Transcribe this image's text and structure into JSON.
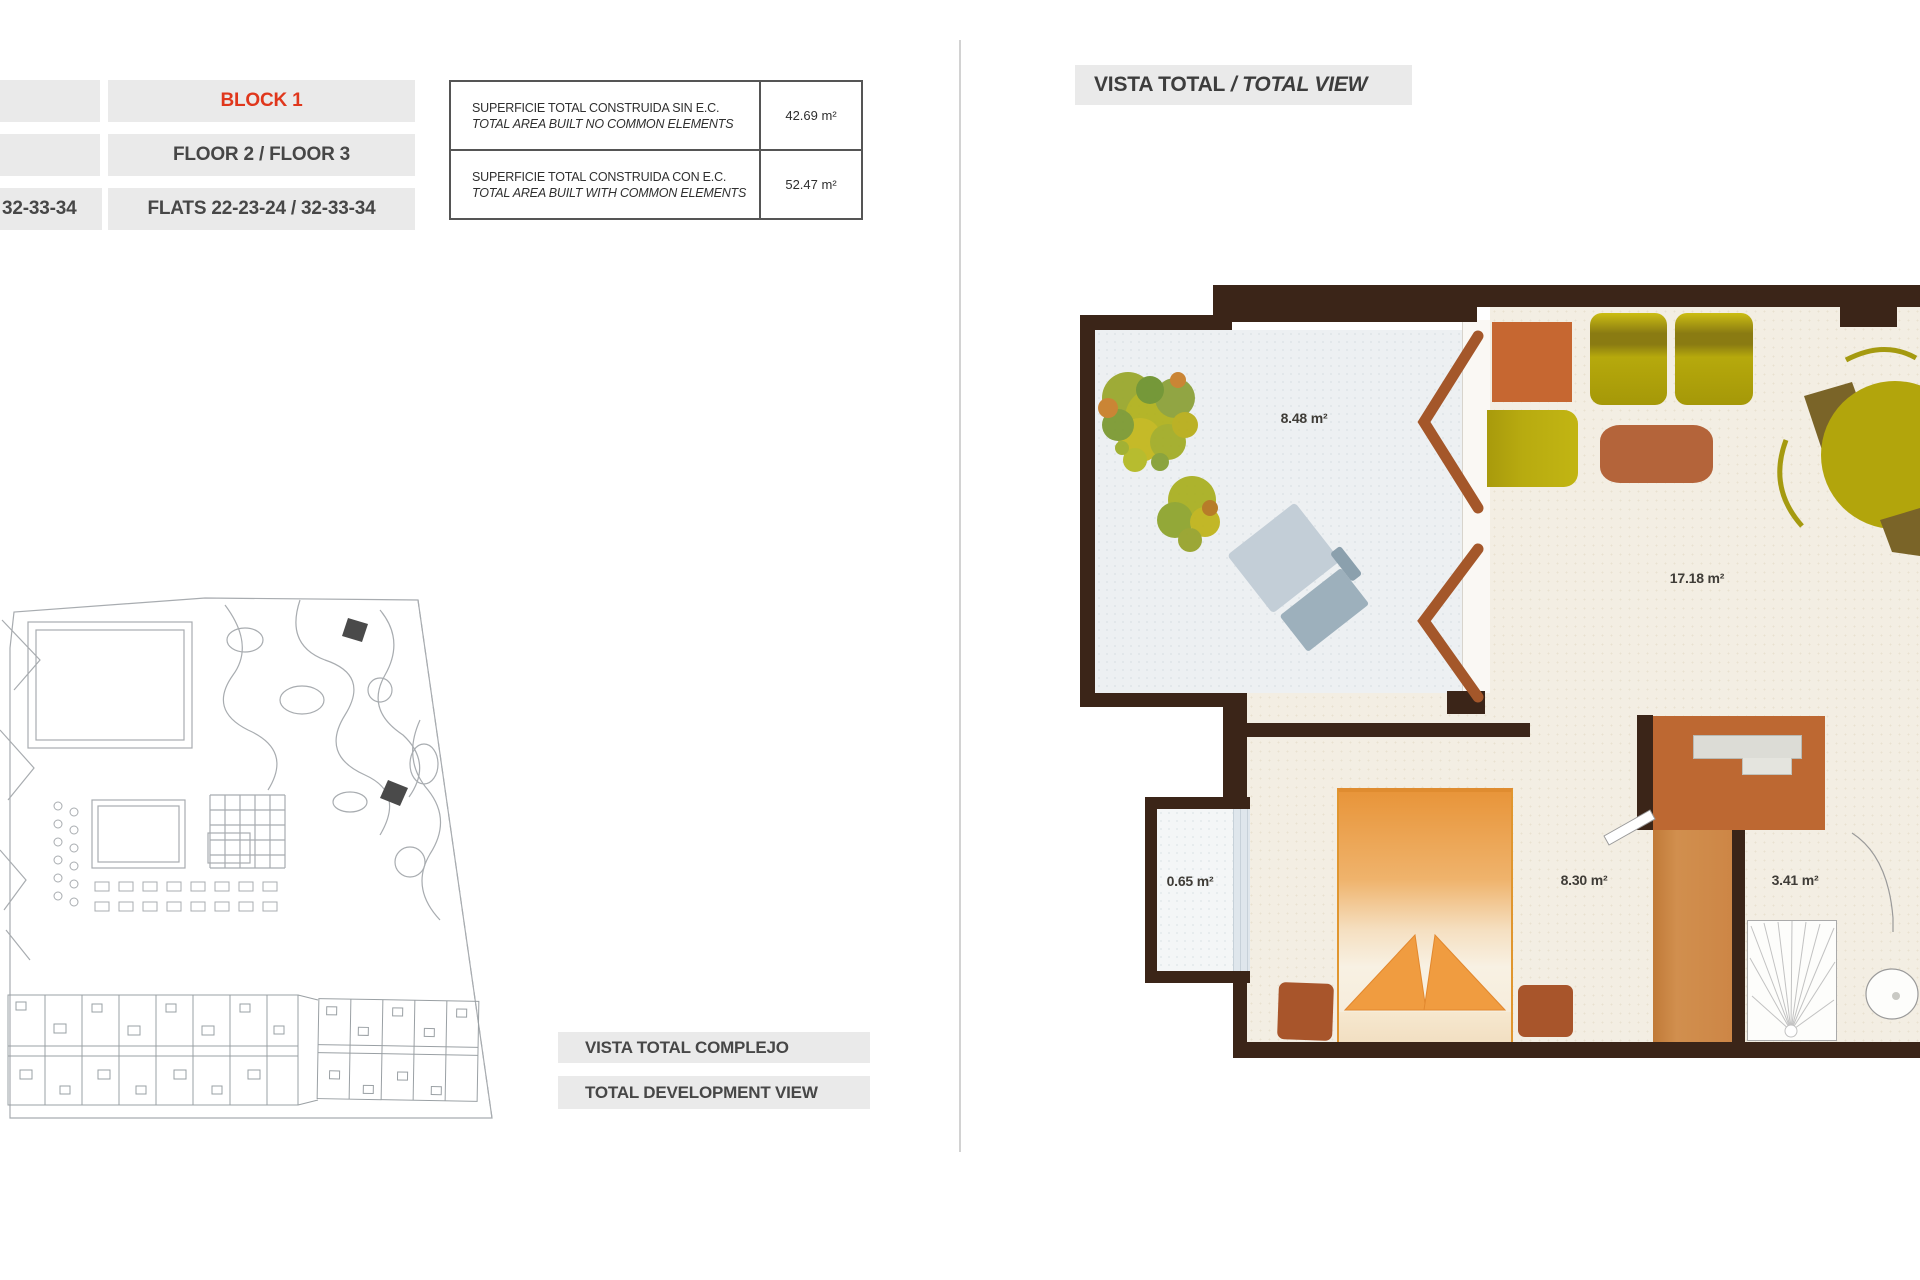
{
  "info_bars": {
    "left_partial": {
      "row1": "",
      "row2": "",
      "row3": "32-33-34"
    },
    "block": {
      "row1": "BLOCK 1",
      "row2": "FLOOR 2 / FLOOR 3",
      "row3": "FLATS 22-23-24 / 32-33-34"
    }
  },
  "area_table": {
    "rows": [
      {
        "label_es": "SUPERFICIE TOTAL CONSTRUIDA SIN E.C.",
        "label_en": "TOTAL AREA BUILT NO COMMON ELEMENTS",
        "value": "42.69 m²"
      },
      {
        "label_es": "SUPERFICIE TOTAL CONSTRUIDA CON E.C.",
        "label_en": "TOTAL AREA BUILT WITH COMMON ELEMENTS",
        "value": "52.47 m²"
      }
    ]
  },
  "right_header": {
    "es": "VISTA TOTAL",
    "sep": " / ",
    "en": "TOTAL VIEW"
  },
  "site_labels": {
    "es": "VISTA TOTAL COMPLEJO",
    "en": "TOTAL DEVELOPMENT VIEW"
  },
  "rooms": {
    "terrace_area": "8.48 m²",
    "living_area": "17.18 m²",
    "closet_area": "0.65 m²",
    "bedroom_area": "8.30 m²",
    "bathroom_area": "3.41 m²"
  },
  "colors": {
    "accent_red": "#e0371c",
    "bar_grey": "#eaeaea",
    "wall_brown": "#3b2518",
    "door_sienna": "#a4572a",
    "floor_cream": "#f3eee3",
    "floor_terrace": "#edf0f2",
    "corridor_orange": "#cd8646"
  }
}
